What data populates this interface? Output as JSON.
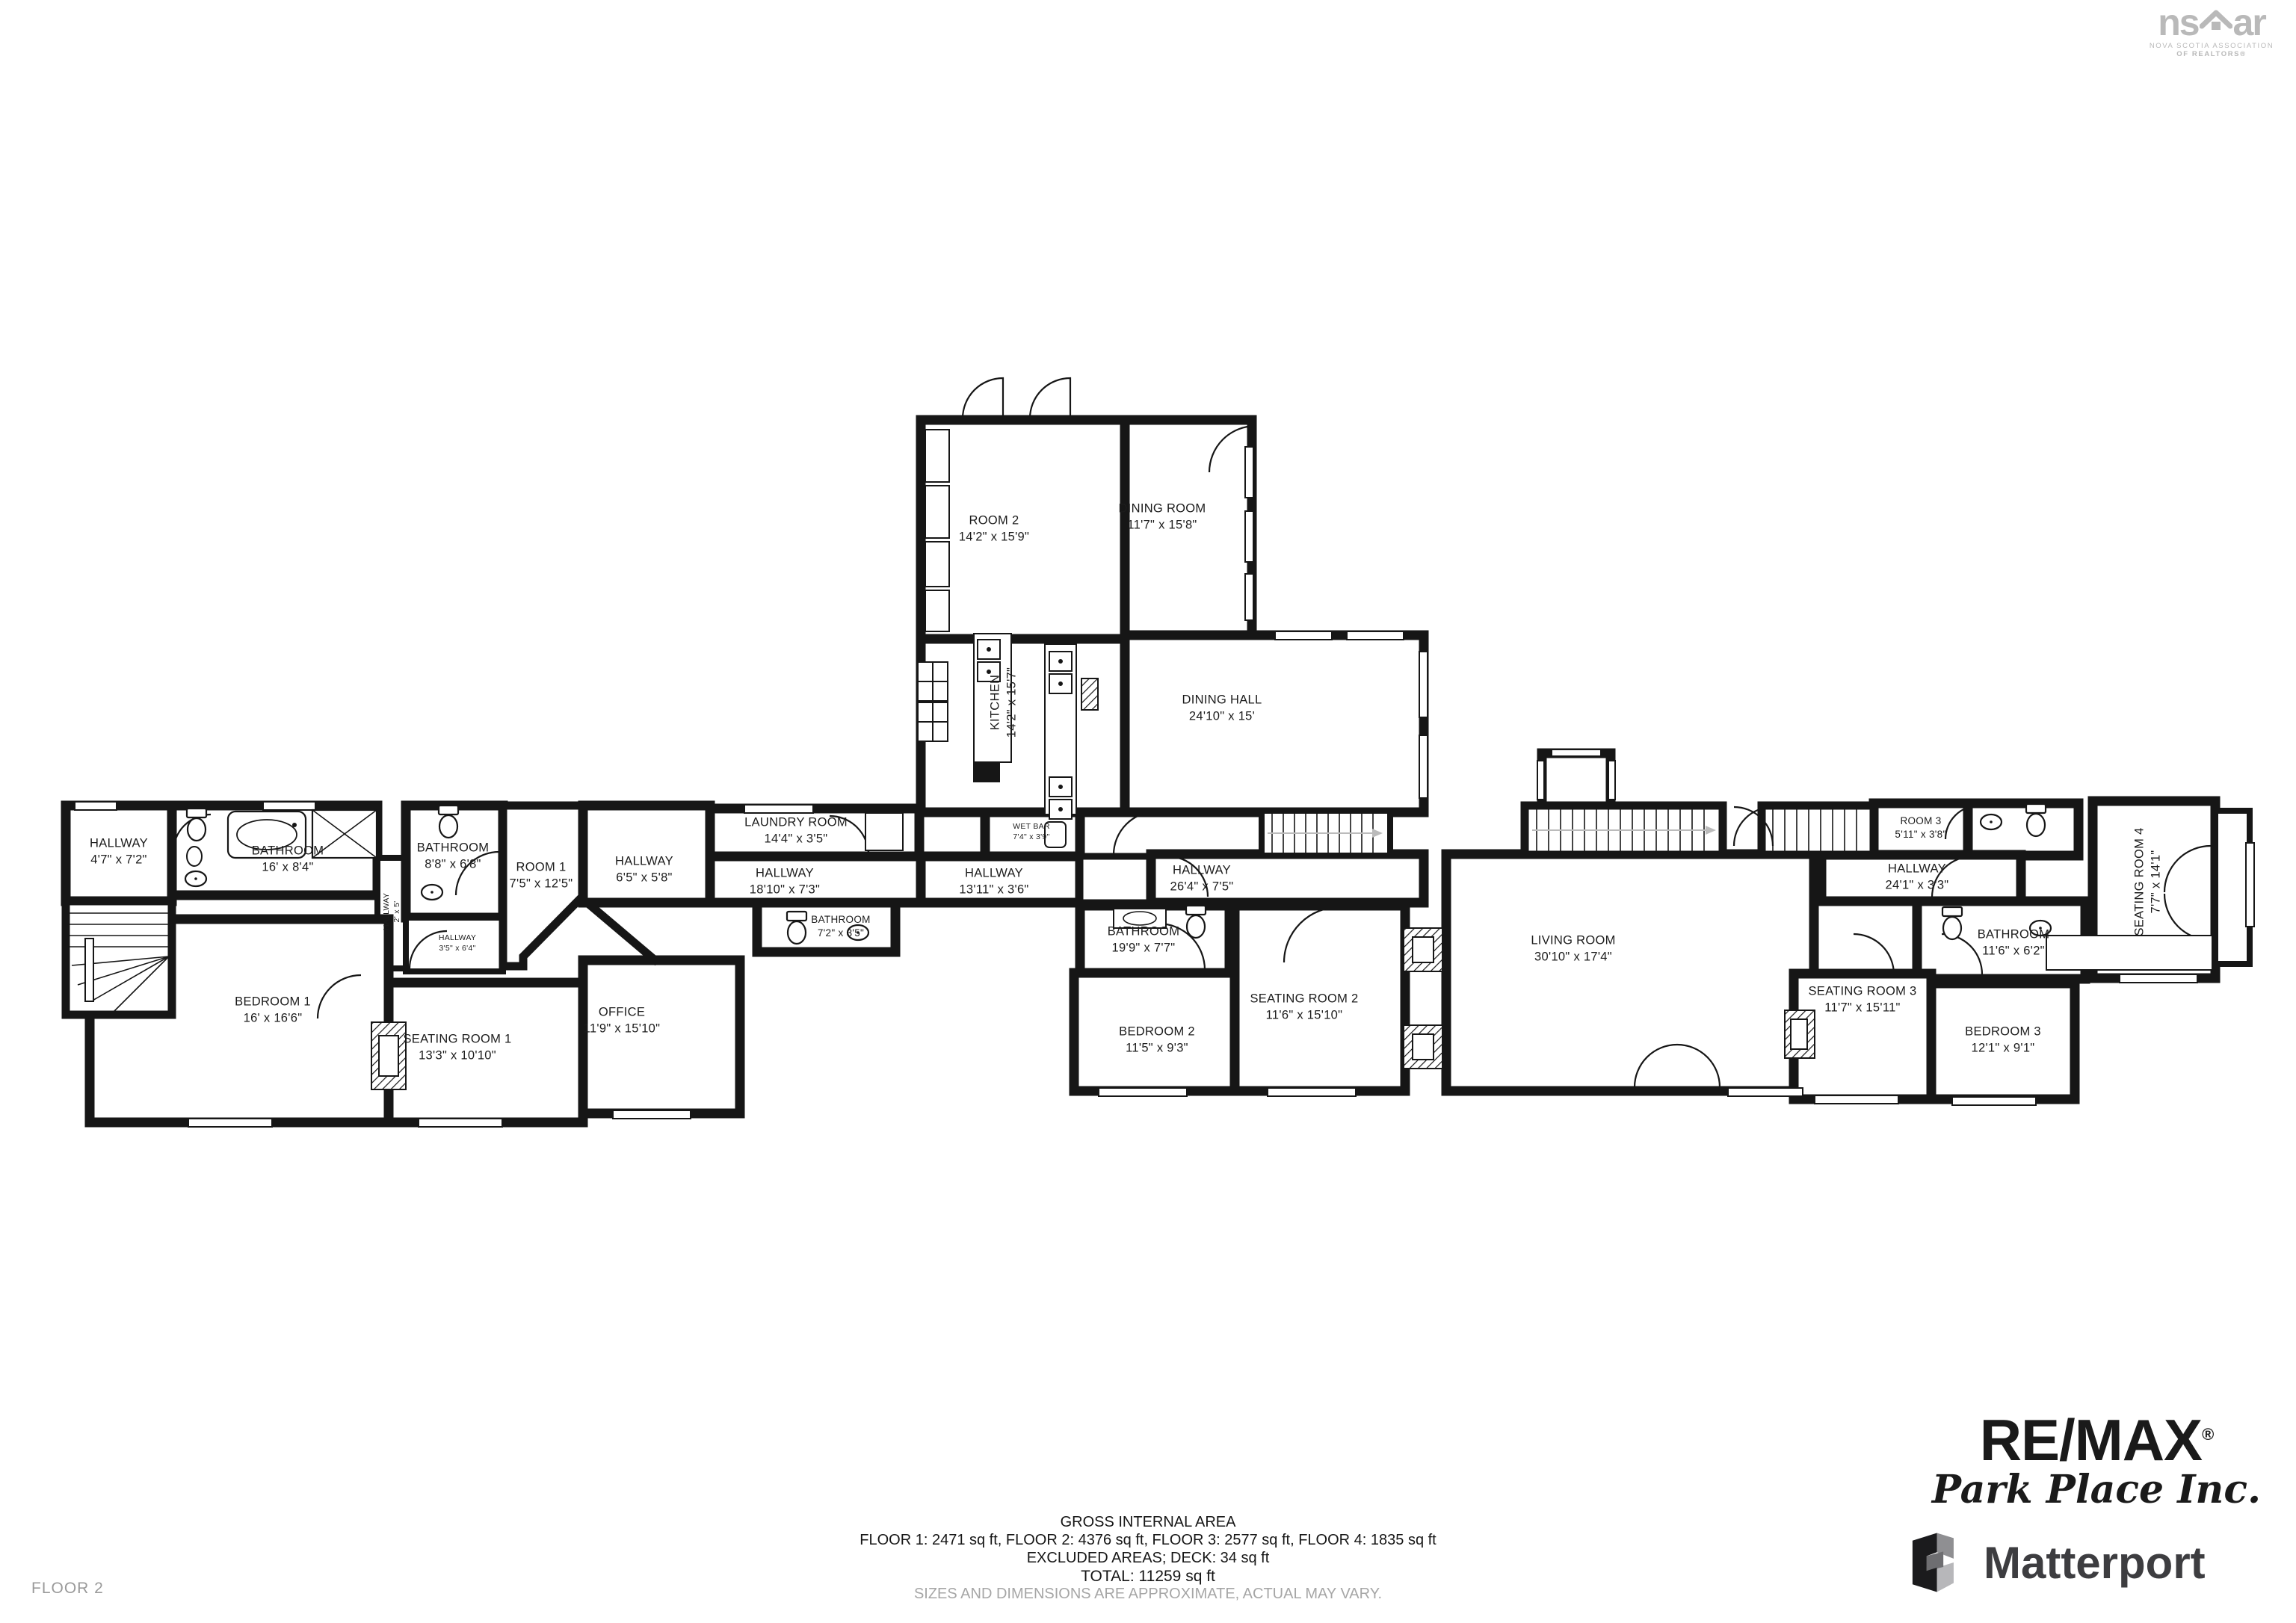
{
  "floor_label": "FLOOR 2",
  "footer": {
    "title": "GROSS INTERNAL AREA",
    "floors": "FLOOR 1: 2471 sq ft, FLOOR 2: 4376 sq ft, FLOOR 3: 2577 sq ft, FLOOR 4: 1835 sq ft",
    "excluded": "EXCLUDED AREAS; DECK: 34 sq ft",
    "total": "TOTAL: 11259 sq ft",
    "disclaimer": "SIZES AND DIMENSIONS ARE APPROXIMATE, ACTUAL MAY VARY."
  },
  "branding": {
    "nsar": {
      "left": "ns",
      "right": "ar",
      "tagline1": "NOVA SCOTIA ASSOCIATION",
      "tagline2": "OF REALTORS®"
    },
    "remax": {
      "name": "RE/MAX",
      "reg": "®",
      "sub": "Park Place Inc."
    },
    "matterport": {
      "name": "Matterport"
    }
  },
  "rooms": [
    {
      "name": "HALLWAY",
      "dims": "4'7\" x 7'2\""
    },
    {
      "name": "BATHROOM",
      "dims": "16' x 8'4\""
    },
    {
      "name": "HALLWAY",
      "dims": "2' x 5'"
    },
    {
      "name": "BATHROOM",
      "dims": "8'8\" x 6'8\""
    },
    {
      "name": "ROOM 1",
      "dims": "7'5\" x 12'5\""
    },
    {
      "name": "HALLWAY",
      "dims": "3'5\" x 6'4\""
    },
    {
      "name": "HALLWAY",
      "dims": "6'5\" x 5'8\""
    },
    {
      "name": "LAUNDRY ROOM",
      "dims": "14'4\" x 3'5\""
    },
    {
      "name": "HALLWAY",
      "dims": "18'10\" x 7'3\""
    },
    {
      "name": "BATHROOM",
      "dims": "7'2\" x 3'5\""
    },
    {
      "name": "HALLWAY",
      "dims": "13'11\" x 3'6\""
    },
    {
      "name": "WET BAR",
      "dims": "7'4\" x 3'9\""
    },
    {
      "name": "ROOM 2",
      "dims": "14'2\" x 15'9\""
    },
    {
      "name": "DINING ROOM",
      "dims": "11'7\" x 15'8\""
    },
    {
      "name": "KITCHEN",
      "dims": "14'2\" x 15'7\""
    },
    {
      "name": "DINING HALL",
      "dims": "24'10\" x 15'"
    },
    {
      "name": "HALLWAY",
      "dims": "26'4\" x 7'5\""
    },
    {
      "name": "BATHROOM",
      "dims": "19'9\" x 7'7\""
    },
    {
      "name": "BEDROOM 2",
      "dims": "11'5\" x 9'3\""
    },
    {
      "name": "SEATING ROOM 2",
      "dims": "11'6\" x 15'10\""
    },
    {
      "name": "LIVING ROOM",
      "dims": "30'10\" x 17'4\""
    },
    {
      "name": "BEDROOM 1",
      "dims": "16' x 16'6\""
    },
    {
      "name": "SEATING ROOM 1",
      "dims": "13'3\" x 10'10\""
    },
    {
      "name": "OFFICE",
      "dims": "11'9\" x 15'10\""
    },
    {
      "name": "ROOM 3",
      "dims": "5'11\" x 3'8\""
    },
    {
      "name": "SEATING ROOM 4",
      "dims": "7'7\" x 14'1\""
    },
    {
      "name": "HALLWAY",
      "dims": "24'1\" x 3'3\""
    },
    {
      "name": "BATHROOM",
      "dims": "11'6\" x 6'2\""
    },
    {
      "name": "SEATING ROOM 3",
      "dims": "11'7\" x 15'11\""
    },
    {
      "name": "BEDROOM 3",
      "dims": "12'1\" x 9'1\""
    }
  ]
}
